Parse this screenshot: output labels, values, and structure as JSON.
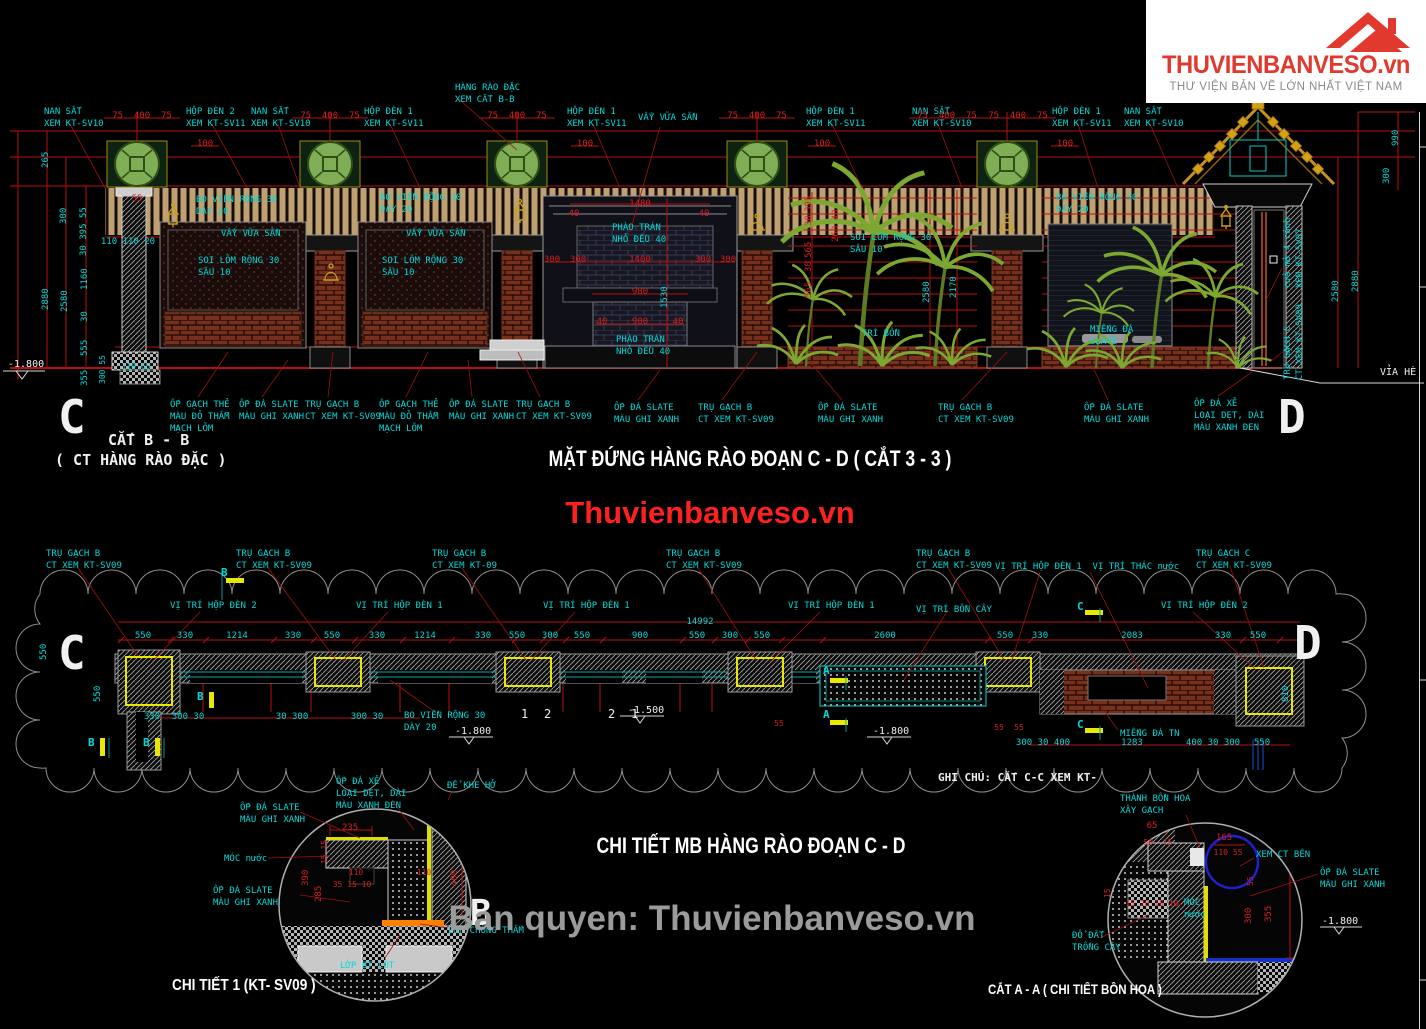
{
  "logo": {
    "brand": "THUVIENBANVESO.vn",
    "tagline": "THƯ VIỆN BẢN VẼ LỚN NHẤT VIỆT NAM"
  },
  "watermarks": {
    "center": "Thuvienbanveso.vn",
    "bottom": "Ban quyen: Thuvienbanveso.vn"
  },
  "titles": {
    "elevation": "MẶT ĐỨNG HÀNG RÀO ĐOẠN C - D ( CẮT 3 - 3 )",
    "plan": "CHI TIẾT MB HÀNG RÀO ĐOẠN C - D",
    "detail1": "CHI TIẾT 1 (KT- SV09 )",
    "detail2": "CẮT A - A ( CHI TIẾT BỒN HOA )"
  },
  "colors": {
    "dimension_red": "#d32020",
    "callout_cyan": "#00d9d9",
    "pillar_yellow": "#e8e800",
    "tree_green": "#7ca832",
    "brand_red": "#e2392e"
  },
  "labels": [
    {
      "t": "NAN SẮT\nXEM KT-SV10",
      "x": 44,
      "y": 106
    },
    {
      "t": "HỘP ĐÈN 2\nXEM KT-SV11",
      "x": 186,
      "y": 106
    },
    {
      "t": "NAN SẮT\nXEM KT-SV10",
      "x": 251,
      "y": 106
    },
    {
      "t": "HÀNG RÀO ĐẶC\nXEM CẮT B-B",
      "x": 455,
      "y": 82
    },
    {
      "t": "HỘP ĐÈN 1\nXEM KT-SV11",
      "x": 364,
      "y": 106
    },
    {
      "t": "HỘP ĐÈN 1\nXEM KT-SV11",
      "x": 567,
      "y": 106
    },
    {
      "t": "VẨY VỮA SẦN",
      "x": 638,
      "y": 112
    },
    {
      "t": "HỘP ĐÈN 1\nXEM KT-SV11",
      "x": 806,
      "y": 106
    },
    {
      "t": "NAN SẮT\nXEM KT-SV10",
      "x": 912,
      "y": 106
    },
    {
      "t": "HỘP ĐÈN 1\nXEM KT-SV11",
      "x": 1052,
      "y": 106
    },
    {
      "t": "NAN SẮT\nXEM KT-SV10",
      "x": 1124,
      "y": 106
    },
    {
      "t": "BO VIỀN RỘNG 30\nDÀY 20",
      "x": 196,
      "y": 194
    },
    {
      "t": "VẨY VỮA SẦN",
      "x": 221,
      "y": 228
    },
    {
      "t": "SOI LÕM RỘNG 30\nSÂU 10",
      "x": 198,
      "y": 255
    },
    {
      "t": "BO VIỀN RỘNG 30\nDÀY 20",
      "x": 380,
      "y": 192
    },
    {
      "t": "VẨY VỮA SẦN",
      "x": 406,
      "y": 228
    },
    {
      "t": "SOI LÕM RỘNG 30\nSÂU 10",
      "x": 382,
      "y": 255
    },
    {
      "t": "PHÀO TRÁN\nNHỎ ĐỀU 40",
      "x": 612,
      "y": 222
    },
    {
      "t": "PHÀO TRÁN\nNHỎ ĐỀU 40",
      "x": 616,
      "y": 334
    },
    {
      "t": "SOI LÕM RỘNG 30\nSÂU 10",
      "x": 850,
      "y": 232
    },
    {
      "t": "TRÍ BỒN",
      "x": 862,
      "y": 328
    },
    {
      "t": "BO VIỀN RỘNG 30\nDÀY 20",
      "x": 1056,
      "y": 192
    },
    {
      "t": "MIẾNG ĐÁ\nSLATE",
      "x": 1090,
      "y": 324
    },
    {
      "t": "cửa mở 4 cánh\nXEM KT-SV07",
      "x": 1282,
      "y": 288,
      "r": 1
    },
    {
      "t": "TRỤ GẠCH C\nCT XEM KT-SV09",
      "x": 1282,
      "y": 380,
      "r": 1
    },
    {
      "t": "ỐP GẠCH THẺ\nMÀU ĐỎ THẪM\nMẠCH LÕM",
      "x": 170,
      "y": 399
    },
    {
      "t": "ỐP ĐÁ SLATE\nMÀU GHI XANH",
      "x": 239,
      "y": 399
    },
    {
      "t": "TRỤ GẠCH B\nCT XEM KT-SV09",
      "x": 305,
      "y": 399
    },
    {
      "t": "ỐP GẠCH THẺ\nMÀU ĐỎ THẪM\nMẠCH LÕM",
      "x": 379,
      "y": 399
    },
    {
      "t": "ỐP ĐÁ SLATE\nMÀU GHI XANH",
      "x": 449,
      "y": 399
    },
    {
      "t": "TRỤ GẠCH B\nCT XEM KT-SV09",
      "x": 516,
      "y": 399
    },
    {
      "t": "ỐP ĐÁ SLATE\nMÀU GHI XANH",
      "x": 614,
      "y": 402
    },
    {
      "t": "TRỤ GẠCH B\nCT XEM KT-SV09",
      "x": 698,
      "y": 402
    },
    {
      "t": "ỐP ĐÁ SLATE\nMÀU GHI XANH",
      "x": 818,
      "y": 402
    },
    {
      "t": "TRỤ GẠCH B\nCT XEM KT-SV09",
      "x": 938,
      "y": 402
    },
    {
      "t": "ỐP ĐÁ SLATE\nMÀU GHI XANH",
      "x": 1084,
      "y": 402
    },
    {
      "t": "ỐP ĐÁ XẺ\nLOẠI DẸT, DÀI\nMÀU XANH ĐEN",
      "x": 1194,
      "y": 398
    },
    {
      "t": "C",
      "x": 58,
      "y": 386,
      "c": "white",
      "s": 46,
      "b": 1
    },
    {
      "t": "D",
      "x": 1278,
      "y": 386,
      "c": "white",
      "s": 46,
      "b": 1
    },
    {
      "t": "CẮT B - B",
      "x": 108,
      "y": 430,
      "c": "white",
      "s": 15,
      "b": 1
    },
    {
      "t": "( CT HÀNG RÀO ĐẶC )",
      "x": 55,
      "y": 450,
      "c": "white",
      "s": 15,
      "b": 1
    },
    {
      "t": "VỈA HÈ",
      "x": 1380,
      "y": 366,
      "c": "white",
      "s": 10
    },
    {
      "t": "-1.800",
      "x": 8,
      "y": 358,
      "c": "white",
      "s": 10
    },
    {
      "t": "75  400  75",
      "x": 142,
      "y": 110,
      "c": "red",
      "a": "c"
    },
    {
      "t": "75  400  75",
      "x": 330,
      "y": 110,
      "c": "red",
      "a": "c"
    },
    {
      "t": "75  400  75",
      "x": 517,
      "y": 110,
      "c": "red",
      "a": "c"
    },
    {
      "t": "75  400  75",
      "x": 757,
      "y": 110,
      "c": "red",
      "a": "c"
    },
    {
      "t": "75  400  75",
      "x": 947,
      "y": 110,
      "c": "red",
      "a": "c"
    },
    {
      "t": "75  400  75",
      "x": 1018,
      "y": 110,
      "c": "red",
      "a": "c"
    },
    {
      "t": "100",
      "x": 205,
      "y": 138,
      "c": "red",
      "a": "c"
    },
    {
      "t": "100",
      "x": 585,
      "y": 138,
      "c": "red",
      "a": "c"
    },
    {
      "t": "100",
      "x": 822,
      "y": 138,
      "c": "red",
      "a": "c"
    },
    {
      "t": "100",
      "x": 1065,
      "y": 138,
      "c": "red",
      "a": "c"
    },
    {
      "t": "1480",
      "x": 640,
      "y": 198,
      "c": "red",
      "a": "c"
    },
    {
      "t": "40",
      "x": 574,
      "y": 208,
      "c": "red",
      "a": "c"
    },
    {
      "t": "40",
      "x": 704,
      "y": 208,
      "c": "red",
      "a": "c"
    },
    {
      "t": "300",
      "x": 552,
      "y": 254,
      "c": "red",
      "a": "c"
    },
    {
      "t": "300",
      "x": 578,
      "y": 254,
      "c": "red",
      "a": "c"
    },
    {
      "t": "1400",
      "x": 640,
      "y": 254,
      "c": "red",
      "a": "c"
    },
    {
      "t": "300",
      "x": 703,
      "y": 254,
      "c": "red",
      "a": "c"
    },
    {
      "t": "300",
      "x": 728,
      "y": 254,
      "c": "red",
      "a": "c"
    },
    {
      "t": "980",
      "x": 640,
      "y": 286,
      "c": "red",
      "a": "c"
    },
    {
      "t": "900",
      "x": 640,
      "y": 316,
      "c": "red",
      "a": "c"
    },
    {
      "t": "40",
      "x": 602,
      "y": 316,
      "c": "red",
      "a": "c"
    },
    {
      "t": "40",
      "x": 678,
      "y": 316,
      "c": "red",
      "a": "c"
    },
    {
      "t": "55",
      "x": 137,
      "y": 193,
      "c": "red",
      "a": "c"
    },
    {
      "t": "110 110 20",
      "x": 128,
      "y": 236,
      "a": "c"
    },
    {
      "t": "110 65",
      "x": 136,
      "y": 362,
      "a": "c",
      "s": 8
    },
    {
      "t": "265",
      "x": 40,
      "y": 168,
      "r": 1
    },
    {
      "t": "300",
      "x": 58,
      "y": 224,
      "r": 1
    },
    {
      "t": "30 395 55",
      "x": 78,
      "y": 256,
      "r": 1
    },
    {
      "t": "2880",
      "x": 40,
      "y": 310,
      "r": 1
    },
    {
      "t": "2580",
      "x": 59,
      "y": 312,
      "r": 1
    },
    {
      "t": "1160",
      "x": 79,
      "y": 290,
      "r": 1
    },
    {
      "t": "30",
      "x": 79,
      "y": 322,
      "r": 1
    },
    {
      "t": "555",
      "x": 79,
      "y": 356,
      "r": 1
    },
    {
      "t": "355",
      "x": 79,
      "y": 386,
      "r": 1
    },
    {
      "t": "300 55",
      "x": 98,
      "y": 384,
      "r": 1,
      "s": 8
    },
    {
      "t": "990",
      "x": 1390,
      "y": 146,
      "r": 1
    },
    {
      "t": "300",
      "x": 1381,
      "y": 184,
      "r": 1
    },
    {
      "t": "2580",
      "x": 1330,
      "y": 302,
      "r": 1
    },
    {
      "t": "2880",
      "x": 1350,
      "y": 292,
      "r": 1
    },
    {
      "t": "1530",
      "x": 659,
      "y": 308,
      "r": 1
    },
    {
      "t": "2580",
      "x": 921,
      "y": 303,
      "r": 1
    },
    {
      "t": "2170",
      "x": 948,
      "y": 298,
      "r": 1
    },
    {
      "t": "260 40",
      "x": 830,
      "y": 242,
      "r": 1,
      "c": "red"
    },
    {
      "t": "395",
      "x": 803,
      "y": 212,
      "r": 1,
      "c": "red"
    },
    {
      "t": "30",
      "x": 803,
      "y": 226,
      "r": 1,
      "c": "red"
    },
    {
      "t": "565",
      "x": 803,
      "y": 258,
      "r": 1,
      "c": "red"
    },
    {
      "t": "30",
      "x": 803,
      "y": 272,
      "r": 1,
      "c": "red"
    },
    {
      "t": "565",
      "x": 803,
      "y": 298,
      "r": 1,
      "c": "red"
    },
    {
      "t": "TRỤ GẠCH B\nCT XEM KT-SV09",
      "x": 46,
      "y": 548
    },
    {
      "t": "TRỤ GẠCH B\nCT XEM KT-SV09",
      "x": 236,
      "y": 548
    },
    {
      "t": "TRỤ GẠCH B\nCT XEM KT-09",
      "x": 432,
      "y": 548
    },
    {
      "t": "TRỤ GẠCH B\nCT XEM KT-SV09",
      "x": 666,
      "y": 548
    },
    {
      "t": "TRỤ GẠCH B\nCT XEM KT-SV09",
      "x": 916,
      "y": 548
    },
    {
      "t": "TRỤ GẠCH C\nCT XEM KT-SV09",
      "x": 1196,
      "y": 548
    },
    {
      "t": "VỊ TRÍ HỘP ĐÈN 2",
      "x": 170,
      "y": 600
    },
    {
      "t": "VỊ TRÍ HỘP ĐÈN 1",
      "x": 356,
      "y": 600
    },
    {
      "t": "VỊ TRÍ HỘP ĐÈN 1",
      "x": 543,
      "y": 600
    },
    {
      "t": "VỊ TRÍ HỘP ĐÈN 1",
      "x": 788,
      "y": 600
    },
    {
      "t": "VỊ TRÍ HỘP ĐÈN 1  VỊ TRÍ THÁC nước",
      "x": 995,
      "y": 561
    },
    {
      "t": "VỊ TRÍ HỘP ĐÈN 2",
      "x": 1161,
      "y": 600
    },
    {
      "t": "VỊ TRÍ BỒN CÂY",
      "x": 916,
      "y": 604
    },
    {
      "t": "BO VIỀN RỘNG 30\nDÀY 20",
      "x": 404,
      "y": 710
    },
    {
      "t": "MIẾNG ĐÁ TN",
      "x": 1120,
      "y": 728
    },
    {
      "t": "GHI CHÚ: CẮT C-C XEM KT-",
      "x": 938,
      "y": 771,
      "c": "white",
      "s": 11,
      "b": 1
    },
    {
      "t": "550",
      "x": 143,
      "y": 630,
      "a": "c"
    },
    {
      "t": "330",
      "x": 185,
      "y": 630,
      "a": "c"
    },
    {
      "t": "1214",
      "x": 237,
      "y": 630,
      "a": "c"
    },
    {
      "t": "330",
      "x": 293,
      "y": 630,
      "a": "c"
    },
    {
      "t": "550",
      "x": 332,
      "y": 630,
      "a": "c"
    },
    {
      "t": "330",
      "x": 377,
      "y": 630,
      "a": "c"
    },
    {
      "t": "1214",
      "x": 425,
      "y": 630,
      "a": "c"
    },
    {
      "t": "330",
      "x": 483,
      "y": 630,
      "a": "c"
    },
    {
      "t": "550",
      "x": 517,
      "y": 630,
      "a": "c"
    },
    {
      "t": "300",
      "x": 550,
      "y": 630,
      "a": "c"
    },
    {
      "t": "550",
      "x": 582,
      "y": 630,
      "a": "c"
    },
    {
      "t": "900",
      "x": 640,
      "y": 630,
      "a": "c"
    },
    {
      "t": "550",
      "x": 697,
      "y": 630,
      "a": "c"
    },
    {
      "t": "300",
      "x": 730,
      "y": 630,
      "a": "c"
    },
    {
      "t": "550",
      "x": 762,
      "y": 630,
      "a": "c"
    },
    {
      "t": "2600",
      "x": 885,
      "y": 630,
      "a": "c"
    },
    {
      "t": "550",
      "x": 1005,
      "y": 630,
      "a": "c"
    },
    {
      "t": "330",
      "x": 1040,
      "y": 630,
      "a": "c"
    },
    {
      "t": "2083",
      "x": 1132,
      "y": 630,
      "a": "c"
    },
    {
      "t": "330",
      "x": 1223,
      "y": 630,
      "a": "c"
    },
    {
      "t": "550",
      "x": 1258,
      "y": 630,
      "a": "c"
    },
    {
      "t": "14992",
      "x": 700,
      "y": 616,
      "a": "c"
    },
    {
      "t": "330",
      "x": 152,
      "y": 711,
      "a": "c"
    },
    {
      "t": "300 30",
      "x": 188,
      "y": 711,
      "a": "c"
    },
    {
      "t": "30 300",
      "x": 292,
      "y": 711,
      "a": "c"
    },
    {
      "t": "300 30",
      "x": 367,
      "y": 711,
      "a": "c"
    },
    {
      "t": "300 30 400",
      "x": 1043,
      "y": 737,
      "a": "c"
    },
    {
      "t": "1283",
      "x": 1132,
      "y": 737,
      "a": "c"
    },
    {
      "t": "400 30 300",
      "x": 1213,
      "y": 737,
      "a": "c"
    },
    {
      "t": "550",
      "x": 1262,
      "y": 737,
      "a": "c"
    },
    {
      "t": "55",
      "x": 779,
      "y": 719,
      "c": "red",
      "s": 8,
      "a": "c"
    },
    {
      "t": "55",
      "x": 999,
      "y": 723,
      "c": "red",
      "s": 8,
      "a": "c"
    },
    {
      "t": "55",
      "x": 1019,
      "y": 723,
      "c": "red",
      "s": 8,
      "a": "c"
    },
    {
      "t": "550",
      "x": 38,
      "y": 660,
      "r": 1
    },
    {
      "t": "550",
      "x": 92,
      "y": 702,
      "r": 1
    },
    {
      "t": "810",
      "x": 1280,
      "y": 702,
      "r": 1
    },
    {
      "t": "C",
      "x": 58,
      "y": 622,
      "c": "white",
      "s": 46,
      "b": 1
    },
    {
      "t": "D",
      "x": 1294,
      "y": 612,
      "c": "white",
      "s": 46,
      "b": 1
    },
    {
      "t": "1",
      "x": 521,
      "y": 706,
      "c": "white",
      "s": 12
    },
    {
      "t": "2",
      "x": 544,
      "y": 706,
      "c": "white",
      "s": 12
    },
    {
      "t": "2",
      "x": 608,
      "y": 706,
      "c": "white",
      "s": 12
    },
    {
      "t": "1",
      "x": 631,
      "y": 706,
      "c": "white",
      "s": 12
    },
    {
      "t": "-1.500",
      "x": 628,
      "y": 704,
      "c": "white",
      "s": 10
    },
    {
      "t": "-1.800",
      "x": 455,
      "y": 725,
      "c": "white",
      "s": 10
    },
    {
      "t": "-1.800",
      "x": 873,
      "y": 725,
      "c": "white",
      "s": 10
    },
    {
      "t": "B",
      "x": 88,
      "y": 736,
      "s": 11,
      "b": 1
    },
    {
      "t": "B",
      "x": 143,
      "y": 736,
      "s": 11,
      "b": 1
    },
    {
      "t": "B",
      "x": 197,
      "y": 690,
      "s": 11,
      "b": 1
    },
    {
      "t": "B",
      "x": 221,
      "y": 566,
      "s": 11,
      "b": 1
    },
    {
      "t": "A",
      "x": 823,
      "y": 664,
      "s": 11,
      "b": 1
    },
    {
      "t": "A",
      "x": 823,
      "y": 708,
      "s": 11,
      "b": 1
    },
    {
      "t": "C",
      "x": 1077,
      "y": 600,
      "s": 11,
      "b": 1
    },
    {
      "t": "C",
      "x": 1077,
      "y": 718,
      "s": 11,
      "b": 1
    },
    {
      "t": "ỐP ĐÁ XẺ\nLOẠI DẸT, DÀI\nMÀU XANH ĐEN",
      "x": 336,
      "y": 776
    },
    {
      "t": "ĐỂ KHE HỞ",
      "x": 447,
      "y": 780
    },
    {
      "t": "ỐP ĐÁ SLATE\nMÀU GHI XANH",
      "x": 240,
      "y": 802
    },
    {
      "t": "MÓC nước",
      "x": 224,
      "y": 853
    },
    {
      "t": "ỐP ĐÁ SLATE\nMÀU GHI XANH",
      "x": 213,
      "y": 885
    },
    {
      "t": "LỚP CHỐNG THẤM",
      "x": 448,
      "y": 925
    },
    {
      "t": "LỚP BT LÓT",
      "x": 340,
      "y": 960
    },
    {
      "t": "B",
      "x": 470,
      "y": 890,
      "c": "white",
      "s": 36,
      "b": 1
    },
    {
      "t": "235",
      "x": 350,
      "y": 822,
      "c": "red",
      "a": "c"
    },
    {
      "t": "110",
      "x": 356,
      "y": 868,
      "c": "red",
      "s": 8,
      "a": "c"
    },
    {
      "t": "110",
      "x": 424,
      "y": 868,
      "c": "red",
      "s": 8,
      "a": "c"
    },
    {
      "t": "35 15 10",
      "x": 352,
      "y": 880,
      "c": "red",
      "s": 8,
      "a": "c"
    },
    {
      "t": "390",
      "x": 300,
      "y": 886,
      "r": 1,
      "c": "red"
    },
    {
      "t": "285",
      "x": 313,
      "y": 902,
      "r": 1,
      "c": "red"
    },
    {
      "t": "400",
      "x": 449,
      "y": 886,
      "r": 1,
      "c": "red"
    },
    {
      "t": "15 15",
      "x": 320,
      "y": 864,
      "r": 1,
      "c": "red",
      "s": 8
    },
    {
      "t": "THÀNH BỒN HOA\nXÂY GẠCH",
      "x": 1120,
      "y": 793
    },
    {
      "t": "XEM CT BÊN",
      "x": 1256,
      "y": 849
    },
    {
      "t": "ỐP ĐÁ SLATE\nMÀU GHI XANH",
      "x": 1320,
      "y": 867
    },
    {
      "t": "MÓC\nnước",
      "x": 1184,
      "y": 897
    },
    {
      "t": "ĐỔ ĐẤT\nTRỒNG CÂY",
      "x": 1072,
      "y": 930
    },
    {
      "t": "-1.800",
      "x": 1322,
      "y": 915,
      "c": "white",
      "s": 10
    },
    {
      "t": "65",
      "x": 1152,
      "y": 820,
      "c": "red",
      "a": "c"
    },
    {
      "t": "50  15",
      "x": 1158,
      "y": 838,
      "c": "red",
      "s": 8,
      "a": "c"
    },
    {
      "t": "165",
      "x": 1224,
      "y": 832,
      "c": "red",
      "a": "c"
    },
    {
      "t": "110 55",
      "x": 1228,
      "y": 848,
      "c": "red",
      "s": 8,
      "a": "c"
    },
    {
      "t": "15 20 10 10",
      "x": 1152,
      "y": 899,
      "c": "red",
      "s": 8,
      "a": "c"
    },
    {
      "t": "300",
      "x": 1243,
      "y": 924,
      "r": 1,
      "c": "red"
    },
    {
      "t": "355",
      "x": 1263,
      "y": 922,
      "r": 1,
      "c": "red"
    },
    {
      "t": "55",
      "x": 1246,
      "y": 886,
      "r": 1,
      "c": "red",
      "s": 8
    },
    {
      "t": "15",
      "x": 1103,
      "y": 898,
      "r": 1,
      "c": "red",
      "s": 8
    }
  ]
}
